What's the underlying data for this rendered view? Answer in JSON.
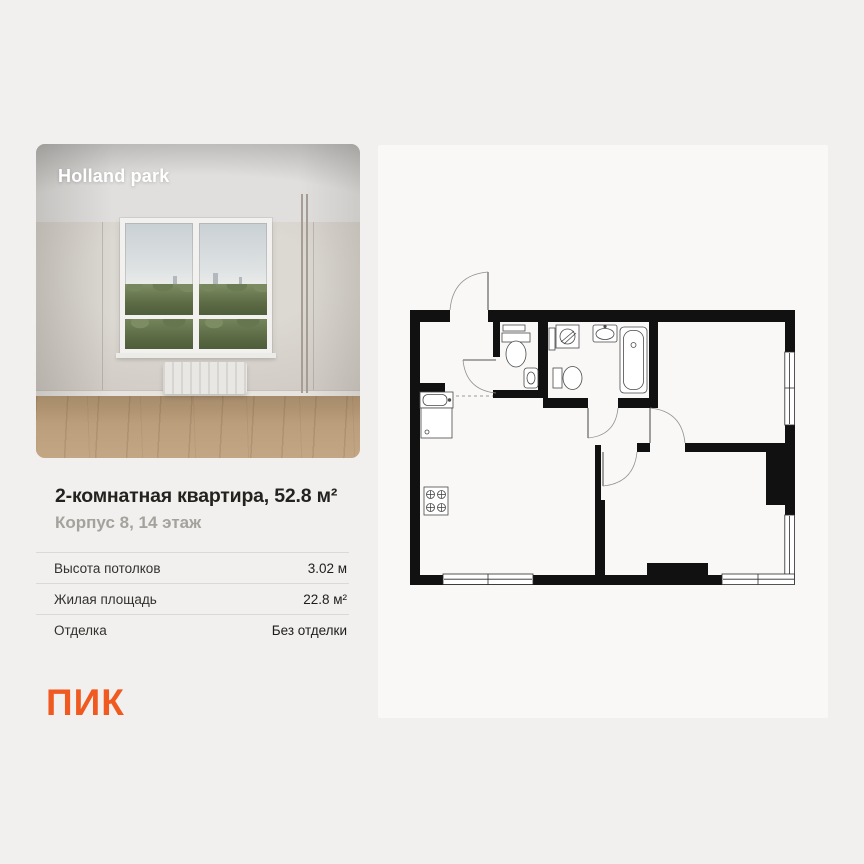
{
  "page": {
    "background": "#f1f0ee"
  },
  "photo_card": {
    "overlay_title": "Holland park"
  },
  "listing": {
    "title": "2-комнатная квартира, 52.8 м²",
    "subtitle": "Корпус 8, 14 этаж",
    "specs": [
      {
        "label": "Высота потолков",
        "value": "3.02 м"
      },
      {
        "label": "Жилая площадь",
        "value": "22.8 м²"
      },
      {
        "label": "Отделка",
        "value": "Без отделки"
      }
    ],
    "brand_logo": "ПИК",
    "brand_color": "#F05A21"
  },
  "floor_plan": {
    "type": "2-room apartment plan",
    "windows_count": 3,
    "interior_doors_count": 4,
    "entrance_doors_count": 1,
    "fixture_icons": [
      "stove-icon",
      "kitchen-sink-icon",
      "dishwasher-icon",
      "wc-toilet-icon",
      "wc-sink-icon",
      "shelf-icon",
      "washing-machine-icon",
      "towel-dryer-icon",
      "bathroom-sink-icon",
      "bathtub-icon",
      "bathroom-toilet-icon"
    ]
  }
}
